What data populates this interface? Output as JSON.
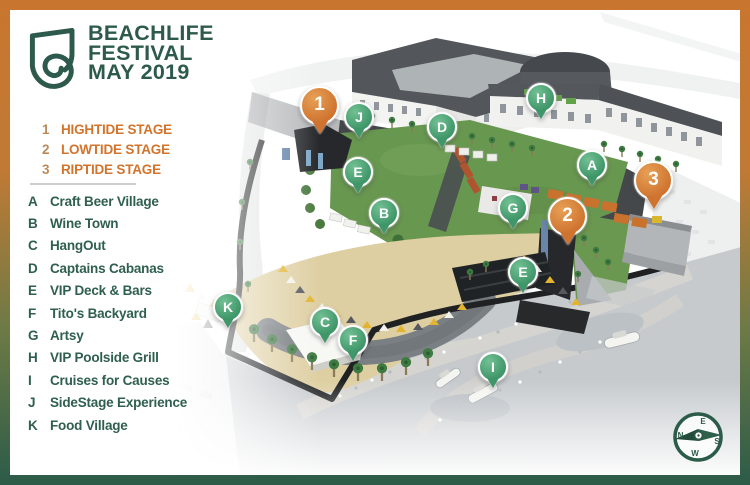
{
  "logo": {
    "line1": "BEACHLIFE",
    "line2": "FESTIVAL",
    "line3": "MAY 2019"
  },
  "legend": {
    "stages": [
      {
        "num": "1",
        "name": "HIGHTIDE STAGE"
      },
      {
        "num": "2",
        "name": "LOWTIDE STAGE"
      },
      {
        "num": "3",
        "name": "RIPTIDE STAGE"
      }
    ],
    "locations": [
      {
        "key": "A",
        "name": "Craft Beer Village"
      },
      {
        "key": "B",
        "name": "Wine Town"
      },
      {
        "key": "C",
        "name": "HangOut"
      },
      {
        "key": "D",
        "name": "Captains Cabanas"
      },
      {
        "key": "E",
        "name": "VIP Deck & Bars"
      },
      {
        "key": "F",
        "name": "Tito's Backyard"
      },
      {
        "key": "G",
        "name": "Artsy"
      },
      {
        "key": "H",
        "name": "VIP Poolside Grill"
      },
      {
        "key": "I",
        "name": "Cruises for Causes"
      },
      {
        "key": "J",
        "name": "SideStage Experience"
      },
      {
        "key": "K",
        "name": "Food Village"
      }
    ]
  },
  "map": {
    "pins": [
      {
        "label": "1",
        "kind": "stage"
      },
      {
        "label": "2",
        "kind": "stage"
      },
      {
        "label": "3",
        "kind": "stage"
      },
      {
        "label": "A",
        "kind": "location"
      },
      {
        "label": "B",
        "kind": "location"
      },
      {
        "label": "C",
        "kind": "location"
      },
      {
        "label": "D",
        "kind": "location"
      },
      {
        "label": "E",
        "kind": "location"
      },
      {
        "label": "E",
        "kind": "location"
      },
      {
        "label": "F",
        "kind": "location"
      },
      {
        "label": "G",
        "kind": "location"
      },
      {
        "label": "H",
        "kind": "location"
      },
      {
        "label": "I",
        "kind": "location"
      },
      {
        "label": "J",
        "kind": "location"
      },
      {
        "label": "K",
        "kind": "location"
      }
    ],
    "compass": {
      "e": "E",
      "n": "N",
      "s": "S",
      "w": "W"
    }
  },
  "colors": {
    "frame_top": "#c8762f",
    "frame_bottom": "#2c5b49",
    "brand_green": "#2d5a4c",
    "accent_orange": "#d2742c",
    "stage_number": "#bb8a5b",
    "pin_orange": "#cf7430",
    "pin_green": "#3f9668",
    "lawn_green": "#689750",
    "sand": "#decfa2"
  }
}
